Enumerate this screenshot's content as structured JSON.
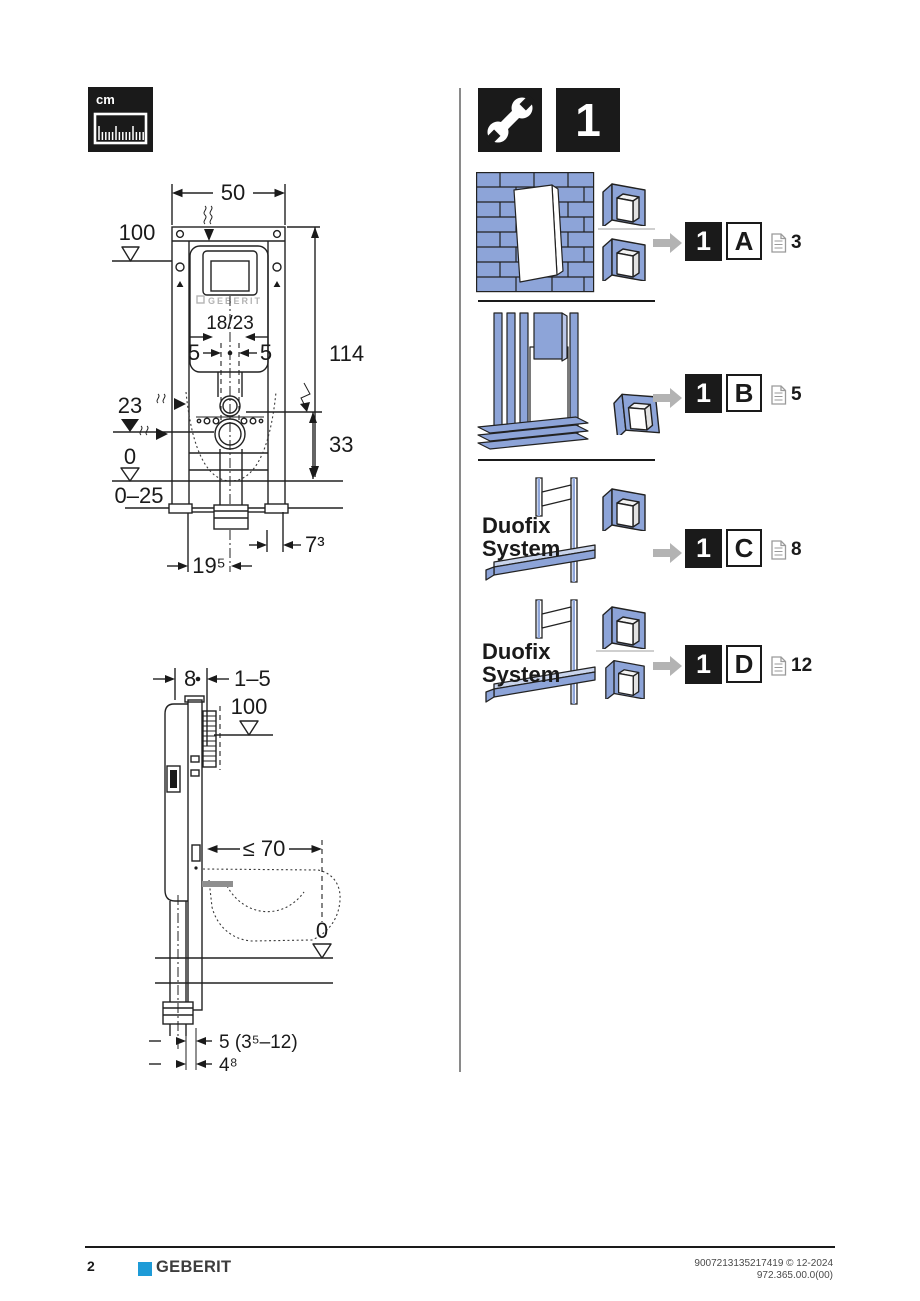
{
  "header": {
    "units_label": "cm",
    "step_number": "1"
  },
  "front_view": {
    "width": "50",
    "height": "114",
    "level_top": "100",
    "level_outlet": "23",
    "level_floor": "0",
    "floor_buildup": "0–25",
    "outlet_height": "33",
    "offset_left": "5",
    "offset_right": "5",
    "brand_label": "GEBERIT",
    "actuation_size": "18/23",
    "outlet_side_offset": "7³",
    "outlet_front_offset": "19⁵"
  },
  "side_view": {
    "frame_depth": "8",
    "front_buildup": "1–5",
    "level_top": "100",
    "bowl_depth_max": "≤ 70",
    "level_floor": "0",
    "drain_depth": "5 (3⁵–12)",
    "drain_offset": "4⁸"
  },
  "variants": [
    {
      "step": "1",
      "letter": "A",
      "page_ref": "3",
      "wall_type": "masonry-wall"
    },
    {
      "step": "1",
      "letter": "B",
      "page_ref": "5",
      "wall_type": "timber-stud-wall"
    },
    {
      "step": "1",
      "letter": "C",
      "page_ref": "8",
      "wall_type": "duofix-system",
      "label_line1": "Duofix",
      "label_line2": "System"
    },
    {
      "step": "1",
      "letter": "D",
      "page_ref": "12",
      "wall_type": "duofix-system",
      "label_line1": "Duofix",
      "label_line2": "System"
    }
  ],
  "footer": {
    "page_number": "2",
    "brand": "GEBERIT",
    "doc_number": "9007213135217419 © 12-2024",
    "doc_code": "972.365.00.0(00)"
  },
  "colors": {
    "accent_blue": "#8da4d8",
    "brand_blue": "#1e9bd7",
    "line_ink": "#1a1a1a",
    "arrow_gray": "#b3b3b3"
  },
  "icons": [
    "ruler-icon",
    "wrench-icon",
    "arrow-right-icon",
    "document-icon",
    "bracket-protector-icon"
  ]
}
